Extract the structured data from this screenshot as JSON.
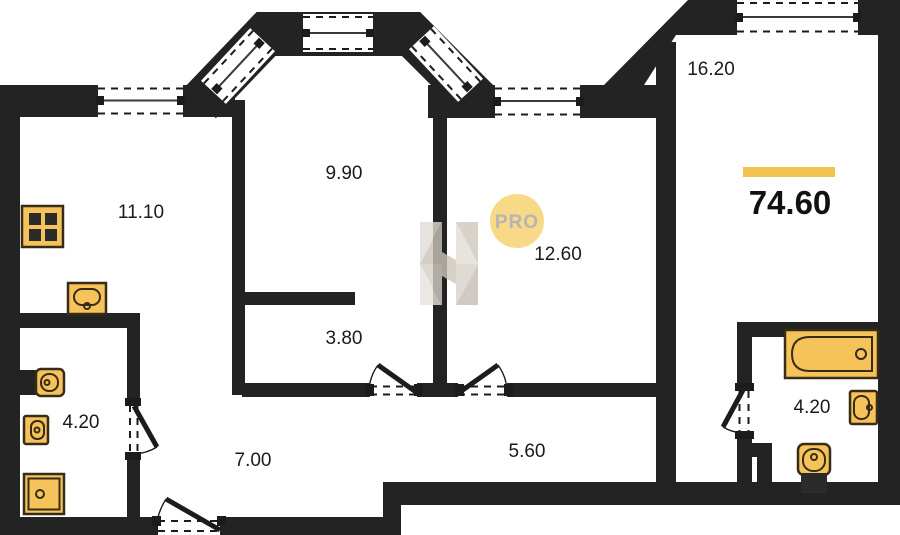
{
  "floorplan": {
    "total": {
      "value": "74.60",
      "accent_bar_color": "#f2c34e"
    },
    "rooms": [
      {
        "name": "kitchen",
        "area": "11.10"
      },
      {
        "name": "living-room",
        "area": "9.90"
      },
      {
        "name": "bedroom",
        "area": "16.20"
      },
      {
        "name": "room",
        "area": "12.60"
      },
      {
        "name": "closet",
        "area": "3.80"
      },
      {
        "name": "bathroom-left",
        "area": "4.20"
      },
      {
        "name": "hallway",
        "area": "7.00"
      },
      {
        "name": "corridor",
        "area": "5.60"
      },
      {
        "name": "bathroom-right",
        "area": "4.20"
      }
    ],
    "watermark": {
      "badge": "PRO",
      "logo": "H-logo",
      "badge_fill": "#f7d06a",
      "badge_text_color": "#a3a3a3"
    },
    "icons": [
      "stove-icon",
      "kitchen-sink-icon",
      "toilet-icon",
      "washbasin-icon",
      "shower-tray-icon",
      "bathtub-icon",
      "window-icon",
      "door-swing-icon"
    ],
    "colors": {
      "wall": "#232323",
      "background": "#ffffff",
      "fixture_fill": "#f5c359",
      "fixture_stroke": "#362c18",
      "label": "#1b1b1b"
    }
  }
}
